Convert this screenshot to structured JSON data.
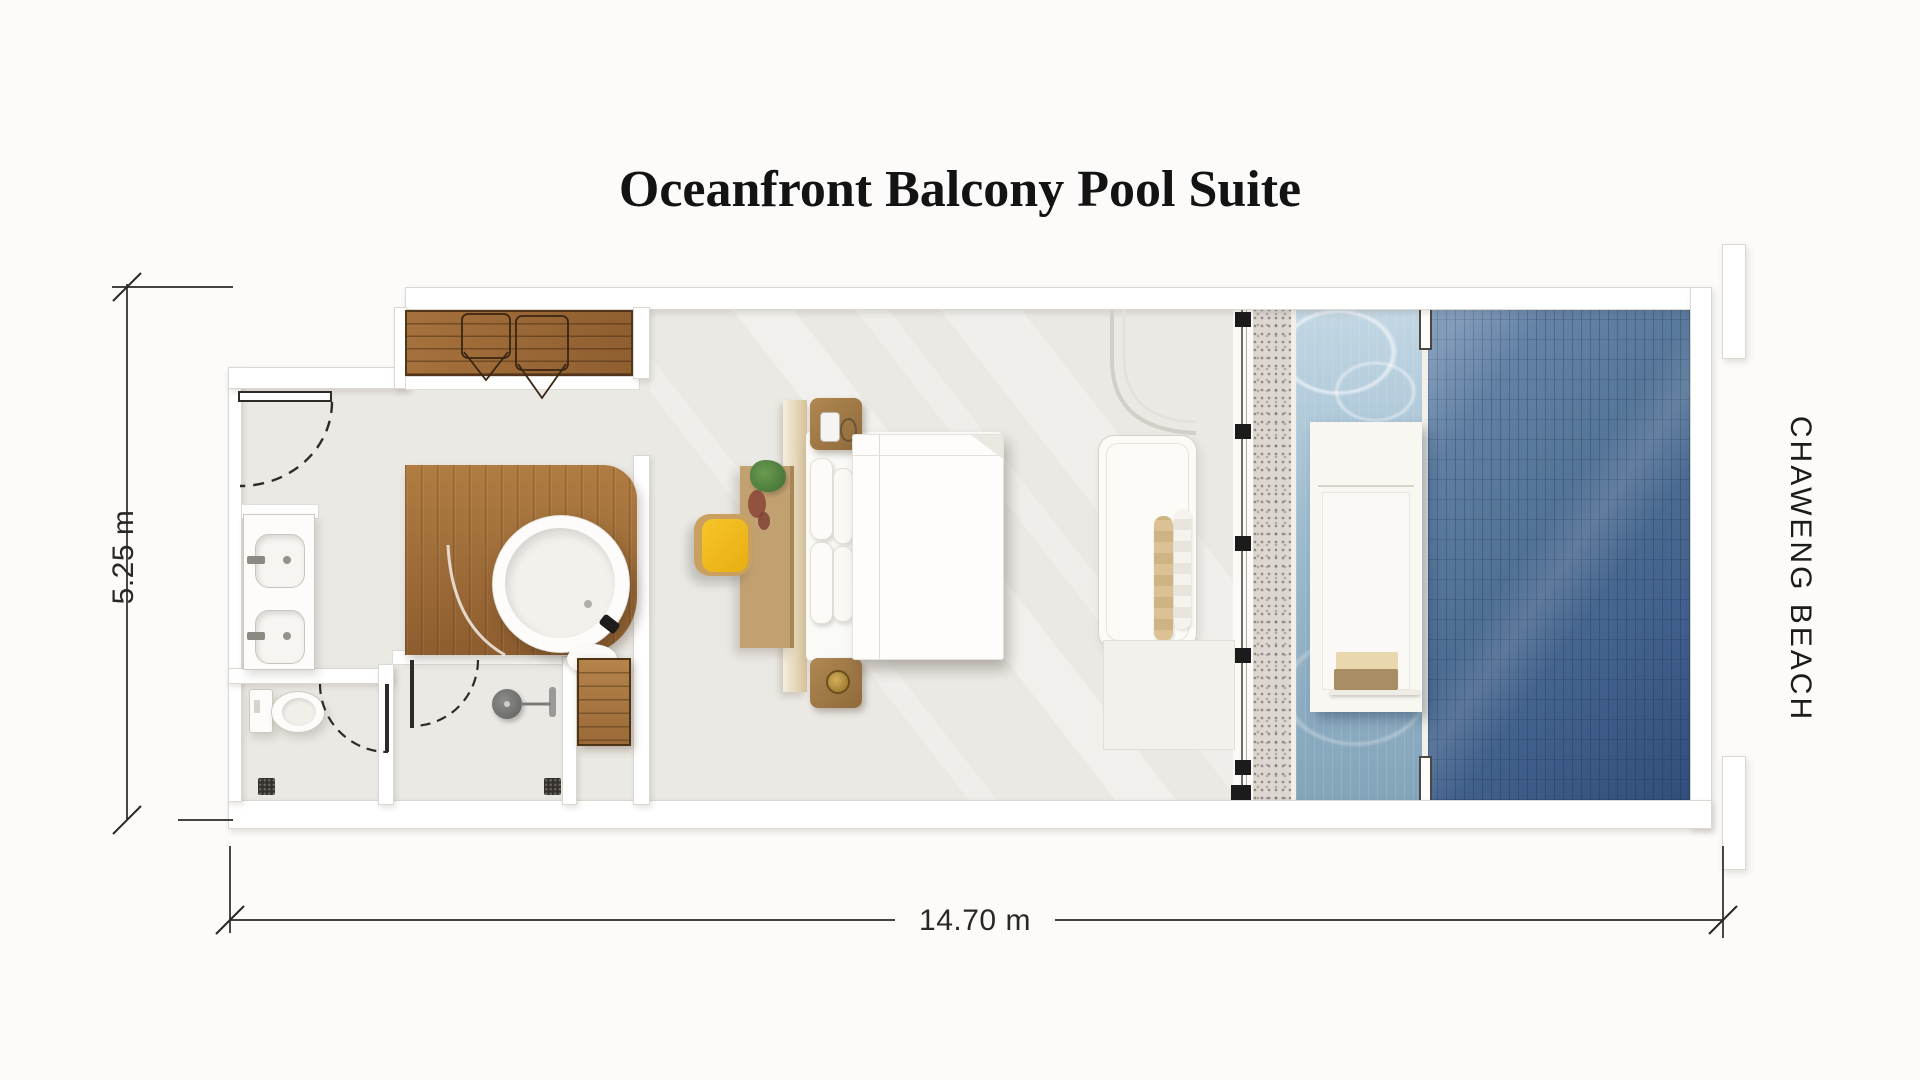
{
  "title": "Oceanfront Balcony Pool Suite",
  "dimensions": {
    "height_label": "5.25 m",
    "width_label": "14.70 m"
  },
  "beach_label": "CHAWENG BEACH",
  "colors": {
    "background": "#fcfbf9",
    "floor": "#ebe9e4",
    "wall": "#ffffff",
    "wood": "#9a6a3c",
    "deck_wood": "#a5713c",
    "desk_wood": "#c2a171",
    "chair_yellow": "#f0bb1f",
    "pool_shallow": "#a9c6d8",
    "pool_deep": "#3a567e",
    "pebble": "#dcd8d1",
    "dimension_text": "#2b2724",
    "title_text": "#131313"
  }
}
